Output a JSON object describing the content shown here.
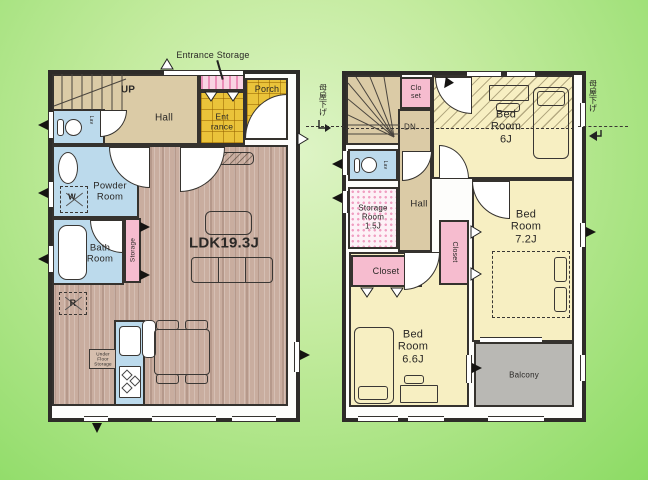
{
  "colors": {
    "background_edge": "#8cdb64",
    "background_center": "#def4c6",
    "wall": "#2e2c29",
    "wood_floor": "#c9ad9f",
    "tatami_yellow": "#f7efc2",
    "wet_area_blue": "#bcdaec",
    "closet_pink": "#f6bccf",
    "hall_tan": "#dbcba6",
    "entrance_tile": "#eac33a",
    "balcony_gray": "#b9b8b4"
  },
  "floor1": {
    "up": "UP",
    "hall": "Hall",
    "entrance_storage": "Entrance Storage",
    "entrance": "Ent\nrance",
    "porch": "Porch",
    "lav": "Lav",
    "powder": "Powder\nRoom",
    "bath": "Bath\nRoom",
    "storage": "Storage",
    "ldk": "LDK19.3J",
    "fridge": "R",
    "washer": "W",
    "under_floor": "Under\nFloor\nStorage"
  },
  "floor2": {
    "dn": "DN",
    "closet_top": "Clo\nset",
    "bedroom6": "Bed\nRoom\n6J",
    "lav": "Lav",
    "storage_room": "Storage\nRoom\n1.5J",
    "hall": "Hall",
    "closet_left": "Closet",
    "closet_mid": "Closet",
    "bedroom72": "Bed\nRoom\n7.2J",
    "bedroom66": "Bed\nRoom\n6.6J",
    "balcony": "Balcony",
    "eaves_left": "母屋下げ",
    "eaves_right": "母屋下げ"
  }
}
